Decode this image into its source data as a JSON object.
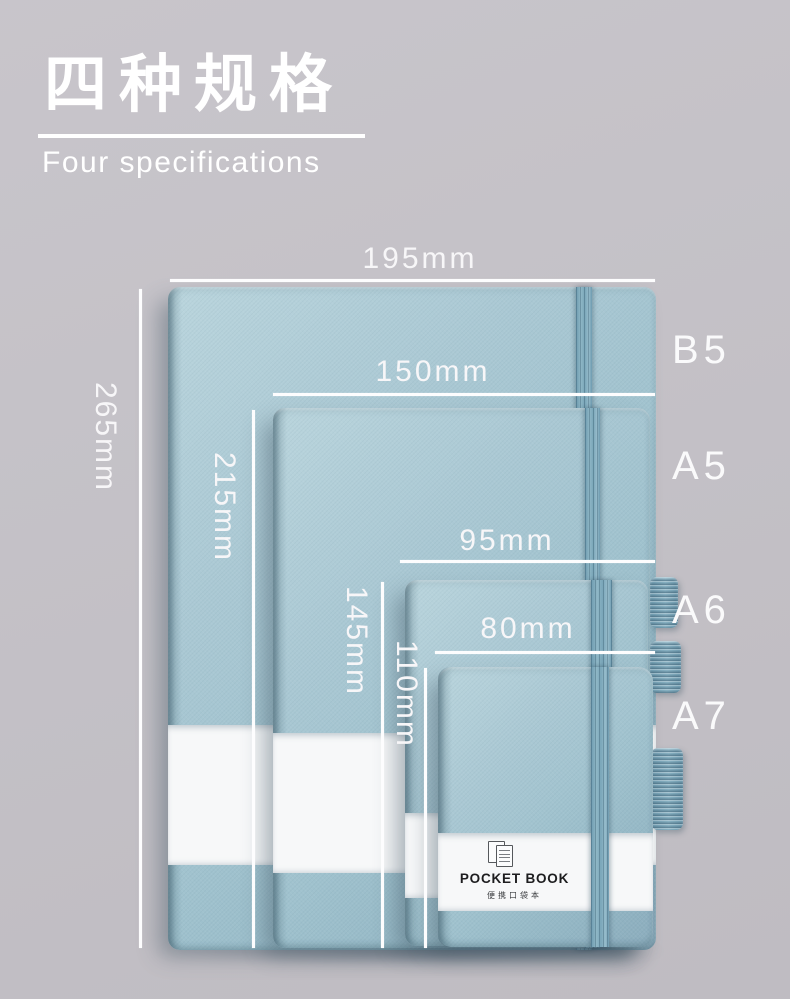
{
  "header": {
    "title_zh": "四种规格",
    "title_en": "Four specifications"
  },
  "specs": [
    {
      "label": "B5",
      "width": "195mm",
      "height": "265mm"
    },
    {
      "label": "A5",
      "width": "150mm",
      "height": "215mm"
    },
    {
      "label": "A6",
      "width": "95mm",
      "height": "145mm"
    },
    {
      "label": "A7",
      "width": "80mm",
      "height": "110mm"
    }
  ],
  "belly_band": {
    "brand": "POCKET BOOK",
    "caption_zh": "便携口袋本",
    "partial_text": ")"
  },
  "colors": {
    "bg": "#c5c2c8",
    "notebook": "#a0c2ce",
    "elastic": "#7fa8ba",
    "band": "#f7f8f9",
    "text": "#ffffff",
    "band-text": "#1d1d1f"
  }
}
